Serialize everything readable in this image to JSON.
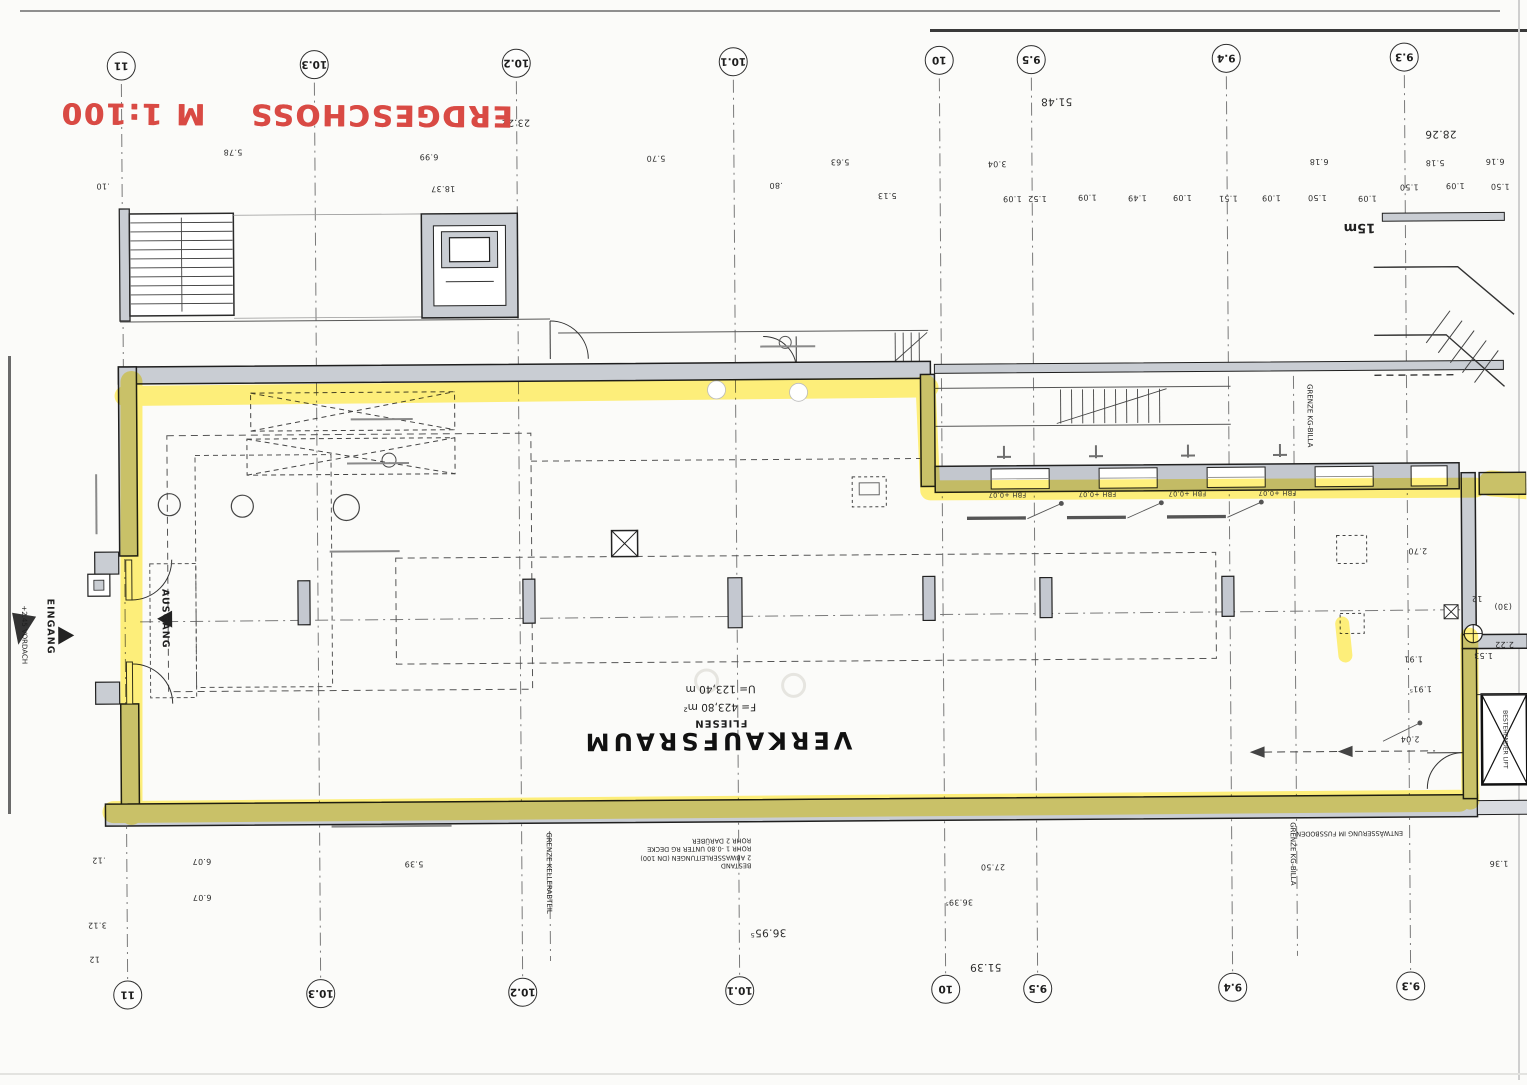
{
  "stamp": {
    "part1": "ERDGESCHOSS",
    "part2": "M 1:100"
  },
  "room": {
    "name": "VERKAUFSRAUM",
    "finish": "FLIESEN",
    "area": "F= 423,80 m²",
    "perimeter": "U= 123,40 m"
  },
  "axes": {
    "top": [
      "11",
      "10.3",
      "10.2",
      "10.1",
      "10",
      "9.5",
      "9.4",
      "9.3"
    ],
    "bottom": [
      "11",
      "10.3",
      "10.2",
      "10.1",
      "10",
      "9.5",
      "9.4",
      "9.3"
    ]
  },
  "dims": [
    ".10",
    "5.78",
    "6.99",
    "18.37",
    "23.22",
    "5.70",
    ".80",
    "5.63",
    "5.13",
    "51.48",
    "3.04",
    "1.09",
    "1.52",
    "1.09",
    "1.49",
    "1.09",
    "1.51",
    "1.09",
    "1.50",
    "1.09",
    "1.50",
    "1.09",
    "1.50",
    "6.18",
    "5.18",
    "28.26",
    "6.16",
    ".12",
    "6.07",
    "6.07",
    "3.12",
    "12",
    "5.39",
    "36.95⁵",
    "27.50",
    "36.39⁵",
    "51.39",
    "1.36",
    "2.70",
    "1.91",
    "1.91⁵",
    "2.04",
    "1.53",
    "2.22",
    "12",
    "(30)"
  ],
  "labels": {
    "scale_bar": "15m",
    "eingang": "EINGANG",
    "ausgang": "AUSGANG",
    "vordach": "+2.45 VORDACH",
    "fbh": "FBH +0.07",
    "grenze_billa": "GRENZE KG-BILLA",
    "grenze_keller": "GRENZE KELLERABTEIL",
    "entwaesserung": "ENTWÄSSERUNG IM FUSSBODEN",
    "lift": "BESTEHENDER LIFT",
    "bestand": {
      "l1": "BESTAND",
      "l2": "2 ABWASSERLEITUNGEN (DN 100)",
      "l3": "ROHR 1  -0.80 UNTER RG DECKE",
      "l4": "ROHR 2  DARÜBER"
    }
  },
  "colors": {
    "highlighter": "#ffe312",
    "stamp_red": "#d94a44",
    "wall_gray": "#c9cdd3"
  }
}
